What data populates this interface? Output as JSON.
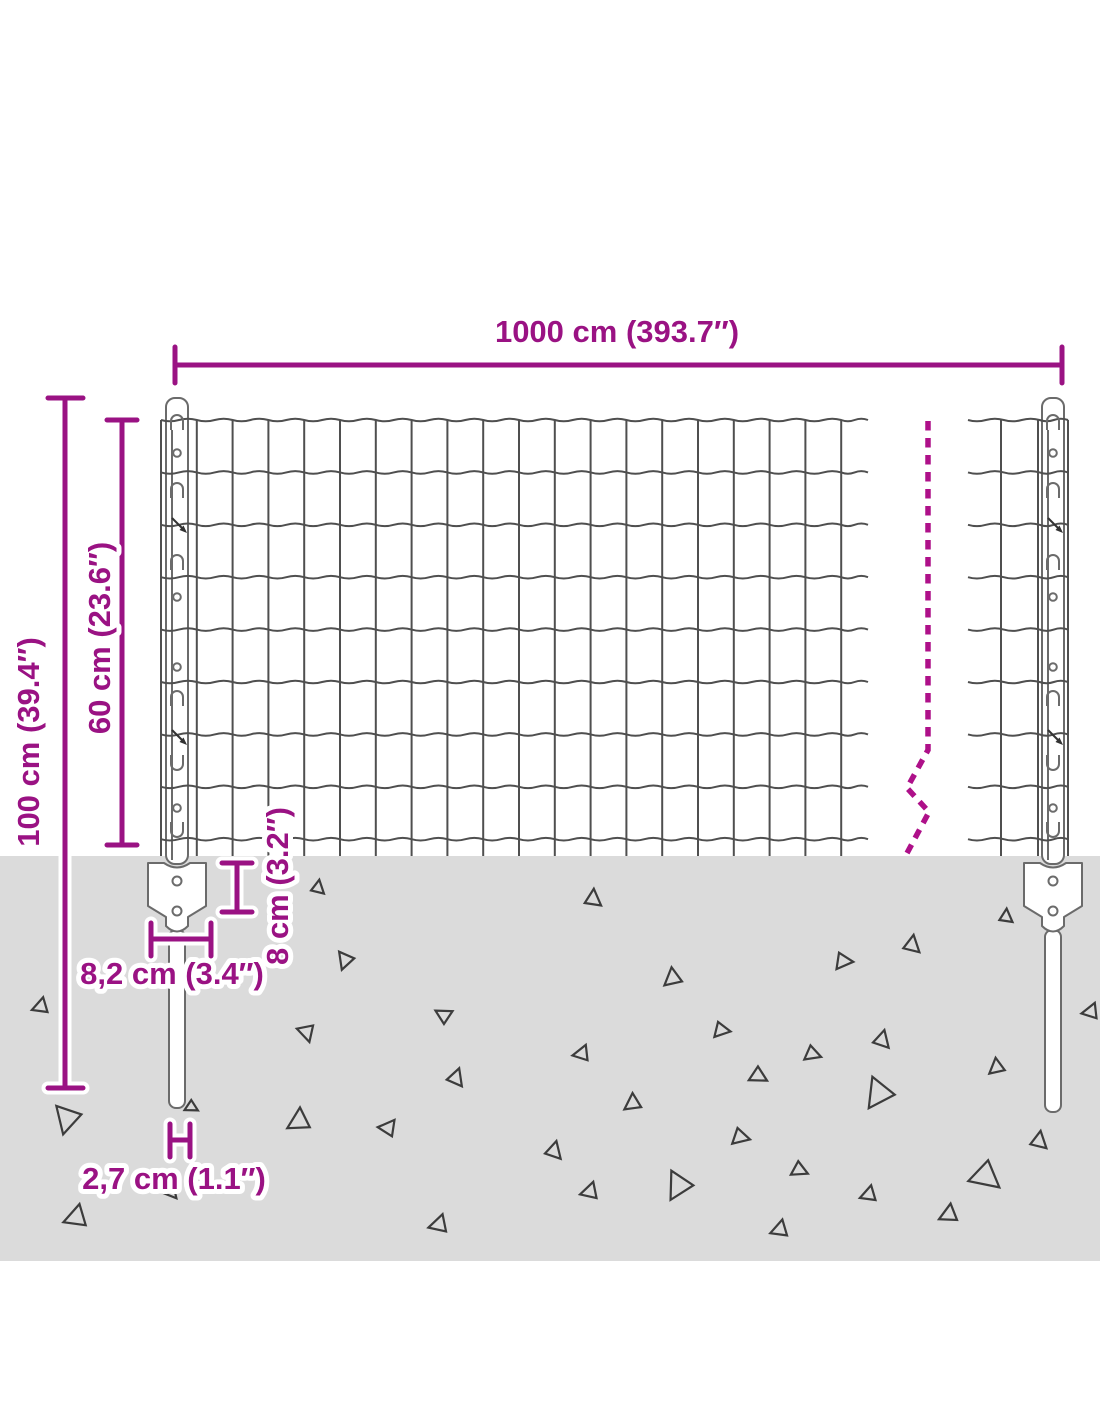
{
  "diagram": {
    "labels": {
      "fence_length": "1000 cm (393.7″)",
      "total_height": "100 cm (39.4″)",
      "mesh_height": "60 cm (23.6″)",
      "anchor_depth": "8 cm (3.2″)",
      "anchor_width": "8,2 cm (3.4″)",
      "post_width": "2,7 cm (1.1″)"
    },
    "colors": {
      "dimension": "#9a1283",
      "break_line": "#ae1089",
      "ground": "#dbdbdb",
      "wire": "#4f4f4f",
      "post_outline": "#6b6b6b",
      "triangle": "#3c3c3c",
      "background": "#ffffff"
    }
  }
}
